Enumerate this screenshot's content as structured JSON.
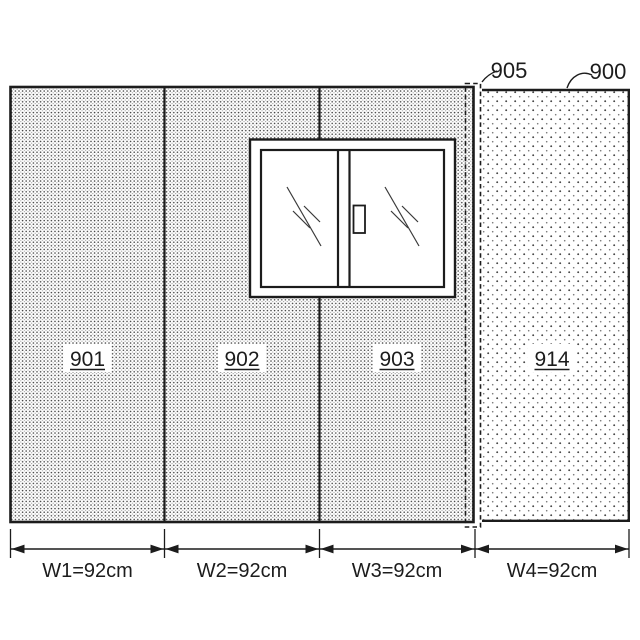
{
  "figure": {
    "background": "#ffffff",
    "line_color": "#1c1c1c",
    "refs": {
      "wall": "900",
      "seam": "905",
      "panel1": "901",
      "panel2": "902",
      "panel3": "903",
      "panel4": "914"
    },
    "dims": {
      "w1": "W1=92cm",
      "w2": "W2=92cm",
      "w3": "W3=92cm",
      "w4": "W4=92cm"
    }
  }
}
